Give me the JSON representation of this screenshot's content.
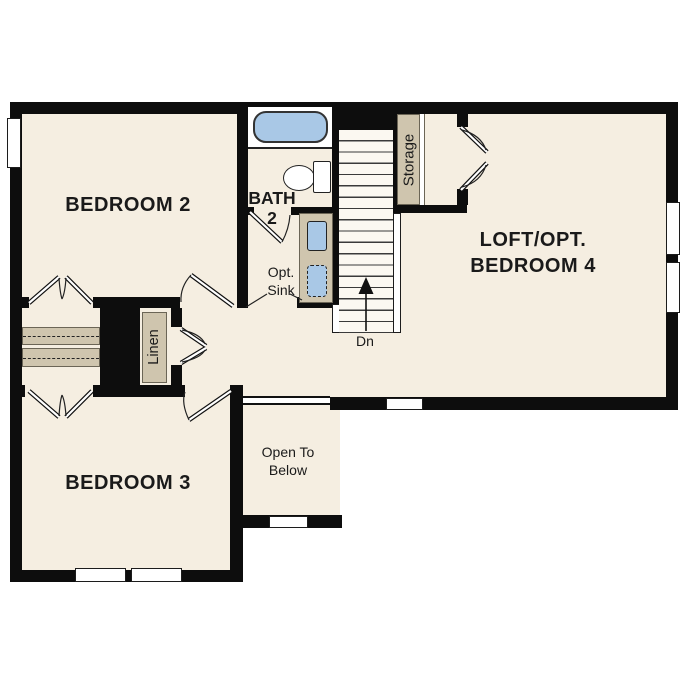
{
  "rooms": {
    "bedroom2": {
      "label": "BEDROOM 2"
    },
    "bath2": {
      "line1": "BATH",
      "line2": "2"
    },
    "loft": {
      "line1": "LOFT/OPT.",
      "line2": "BEDROOM 4"
    },
    "bedroom3": {
      "label": "BEDROOM 3"
    },
    "open_below": {
      "line1": "Open To",
      "line2": "Below"
    },
    "opt_sink": {
      "line1": "Opt.",
      "line2": "Sink"
    },
    "linen": {
      "label": "Linen"
    },
    "storage": {
      "label": "Storage"
    },
    "stairs": {
      "direction_label": "Dn"
    }
  },
  "colors": {
    "floor": "#f5eee1",
    "wall": "#0d0d0d",
    "fixture_tan": "#cfc5ae",
    "water_blue": "#a9c8e6",
    "stair_bg": "#fbf8f1"
  }
}
